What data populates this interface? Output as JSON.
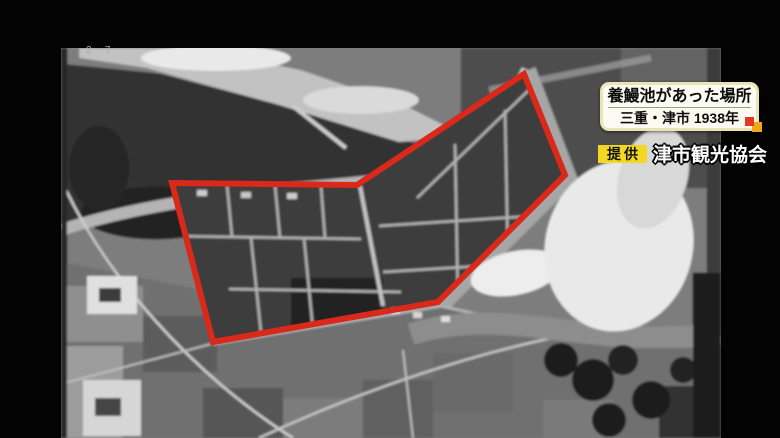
{
  "colors": {
    "outline-red": "#d9291b",
    "caption-border": "#e7e4b5",
    "accent-red": "#e23a20",
    "accent-yellow": "#f0a81b",
    "credit-badge-bg": "#f3d722"
  },
  "photo": {
    "annotation": "2-7",
    "caption_box": {
      "title": "養鰻池があった場所",
      "subtitle": "三重・津市 1938年"
    },
    "credit": {
      "label": "提供",
      "name": "津市観光協会"
    }
  }
}
